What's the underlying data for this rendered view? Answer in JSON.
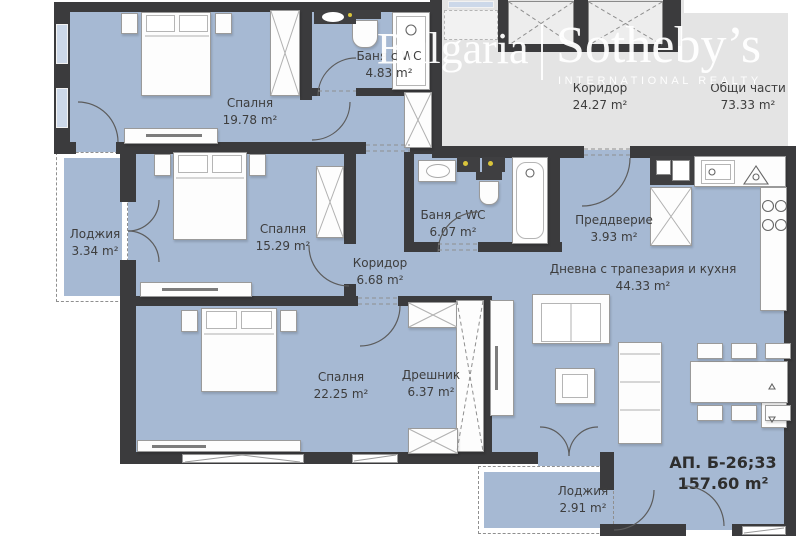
{
  "watermark": {
    "region": "Bulgaria",
    "brand": "Sotheby’s",
    "tagline": "INTERNATIONAL REALTY"
  },
  "apartment": {
    "label": "АП. Б-26;33",
    "area": "157.60 m²"
  },
  "rooms": [
    {
      "key": "bedroom-1",
      "label": "Спалня",
      "area": "19.78 m²"
    },
    {
      "key": "bath-1",
      "label": "Баня с WC",
      "area": "4.83 m²"
    },
    {
      "key": "corridor-common",
      "label": "Коридор",
      "area": "24.27 m²"
    },
    {
      "key": "common-parts",
      "label": "Общи части",
      "area": "73.33 m²"
    },
    {
      "key": "loggia-left",
      "label": "Лоджия",
      "area": "3.34 m²"
    },
    {
      "key": "bedroom-2",
      "label": "Спалня",
      "area": "15.29 m²"
    },
    {
      "key": "corridor",
      "label": "Коридор",
      "area": "6.68 m²"
    },
    {
      "key": "bath-2",
      "label": "Баня с WC",
      "area": "6.07 m²"
    },
    {
      "key": "entry",
      "label": "Преддверие",
      "area": "3.93 m²"
    },
    {
      "key": "living",
      "label": "Дневна с трапезария и кухня",
      "area": "44.33 m²"
    },
    {
      "key": "bedroom-3",
      "label": "Спалня",
      "area": "22.25 m²"
    },
    {
      "key": "closet",
      "label": "Дрешник",
      "area": "6.37 m²"
    },
    {
      "key": "loggia-bottom",
      "label": "Лоджия",
      "area": "2.91 m²"
    }
  ],
  "colors": {
    "room_fill": "#a6b9d3",
    "wall": "#3b3b3d",
    "common_area": "#e4e4e4",
    "watermark": "#ffffff",
    "label_text": "#3d3d3d"
  }
}
